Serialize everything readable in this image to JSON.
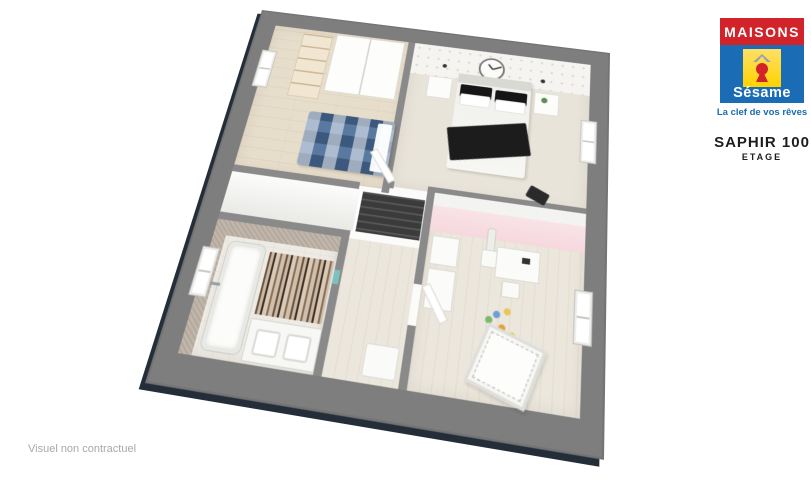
{
  "branding": {
    "name_top": "MAISONS",
    "name_bottom": "Sésame",
    "tagline": "La clef de vos rêves",
    "icons": {
      "logo_roof": "roof-icon",
      "logo_keyhole": "keyhole-icon"
    }
  },
  "model": {
    "name": "SAPHIR 100",
    "level": "ETAGE"
  },
  "footer": {
    "disclaimer": "Visuel non contractuel"
  },
  "palette": {
    "brand-red": "#d2232b",
    "brand-blue": "#1a6cb5",
    "brand-yellow": "#ffd200",
    "frame": "#7e7e7e",
    "cap": "#8a8a8a",
    "wood": "#e7ddcb",
    "wood-light": "#ece7dc",
    "carpet": "#e9e4d9",
    "pink": "#f5d8dd",
    "taupe": "#b4a89b",
    "bed-blue": "#5a79a1",
    "ink": "#1d1d1b",
    "muted": "#a8a8a8"
  },
  "floorplan": {
    "view": "3d-top-down-etage",
    "rooms": [
      {
        "id": "bedroom-1"
      },
      {
        "id": "master-bedroom"
      },
      {
        "id": "bathroom"
      },
      {
        "id": "kids-bedroom"
      },
      {
        "id": "landing-stairs"
      }
    ]
  }
}
